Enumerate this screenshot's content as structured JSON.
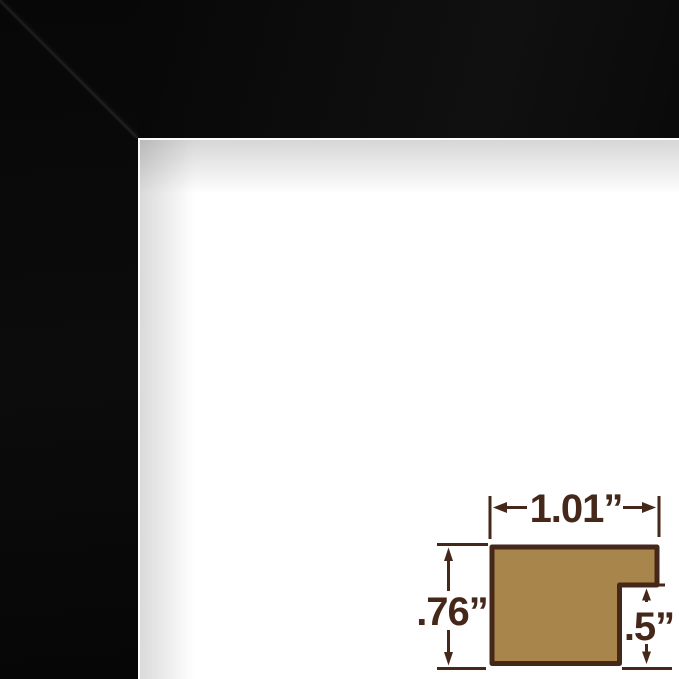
{
  "image": {
    "description": "Close-up of a black picture frame corner over a white opening, with a frame moulding profile dimension diagram overlaid at the bottom right",
    "frame_color": "#0b0b0b",
    "background_color": "#ffffff"
  },
  "diagram": {
    "type": "frame-profile-cross-section",
    "fill_color": "#a8854a",
    "line_color": "#46281a",
    "dimensions": {
      "width_label": "1.01”",
      "height_label": ".76”",
      "rabbet_depth_label": ".5”",
      "width_inches": 1.01,
      "height_inches": 0.76,
      "rabbet_depth_inches": 0.5,
      "unit": "inches"
    }
  }
}
